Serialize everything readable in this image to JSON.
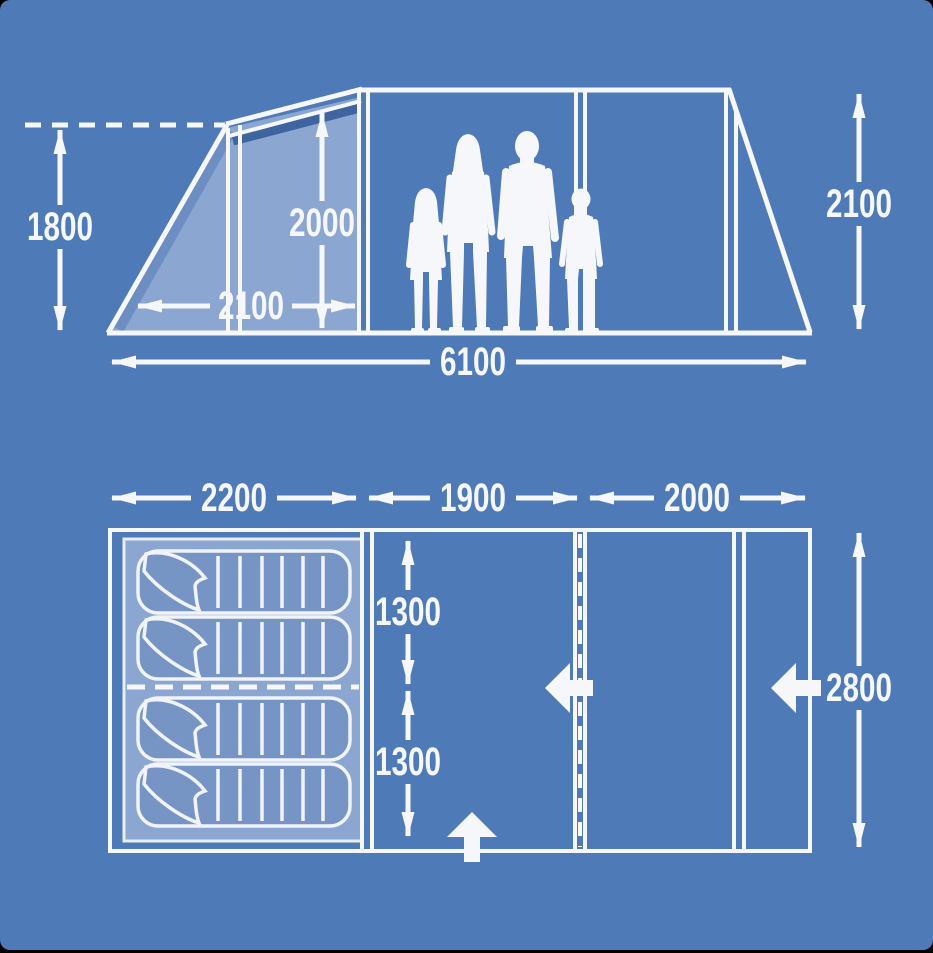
{
  "diagram_type": "tent-dimensions",
  "colors": {
    "background": "#4e7bb7",
    "light_panel": "#8ba7d1",
    "sleeping_bag_fill": "#7694c4",
    "roof_shadow": "#3f65a0",
    "slant_shadow": "#6d8ec3",
    "line_white": "#f5f7fa",
    "frame_black": "#000000"
  },
  "side_view": {
    "awning_height_label": "1800",
    "interior_height_label": "2000",
    "awning_depth_label": "2100",
    "total_length_label": "6100",
    "rear_height_label": "2100"
  },
  "floor_plan": {
    "bedroom_length_label": "2200",
    "middle_section_label": "1900",
    "front_section_label": "2000",
    "bedroom_half_width_top_label": "1300",
    "bedroom_half_width_bottom_label": "1300",
    "total_width_label": "2800"
  }
}
